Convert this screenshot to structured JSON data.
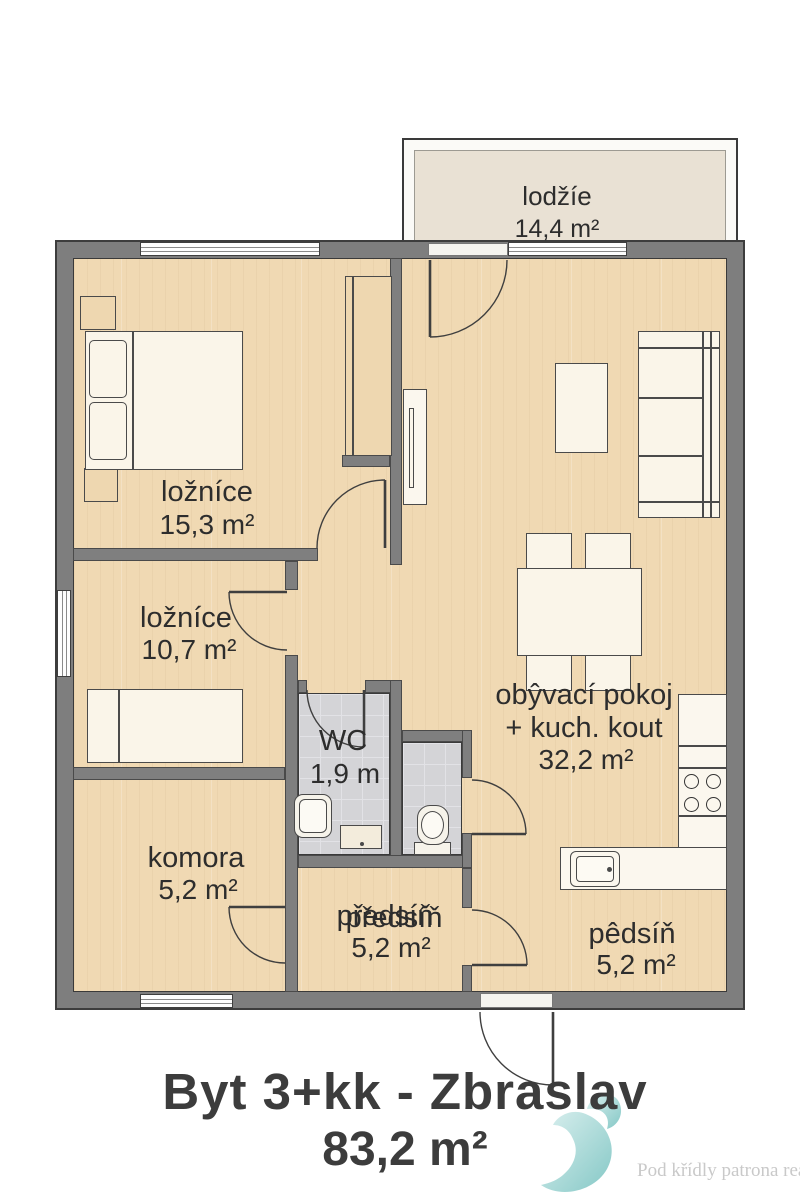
{
  "plan": {
    "title_line1": "Byt 3+kk - Zbraslav",
    "title_line2": "83,2 m²",
    "watermark_text": "Pod křídly patrona realit",
    "rooms": {
      "lodzie": {
        "name": "lodžíe",
        "area": "14,4 m²"
      },
      "loznice1": {
        "name": "ložníce",
        "area": "15,3 m²"
      },
      "loznice2": {
        "name": "ložníce",
        "area": "10,7 m²"
      },
      "wc": {
        "name": "WC",
        "area": "1,9 m"
      },
      "komora": {
        "name": "komora",
        "area": "5,2 m²"
      },
      "chodba": {
        "name": "předsíň",
        "name_ghost": "předsíň",
        "area": "5,2 m²"
      },
      "obyvaci": {
        "name_line1": "obŷvací pokoj",
        "name_line2": "+ kuch. kout",
        "area": "32,2 m²"
      },
      "predsin": {
        "name": "pêdsíň",
        "area": "5,2 m²"
      }
    },
    "colors": {
      "wall": "#7e7e7e",
      "floor_wood": "#f0d9b3",
      "floor_tile": "#d4d4d7",
      "loggia_floor": "#e9e1d4",
      "outline": "#3a3a3a",
      "logo_teal": "#8ecfcd",
      "watermark_gray": "#c9c9c9"
    }
  }
}
